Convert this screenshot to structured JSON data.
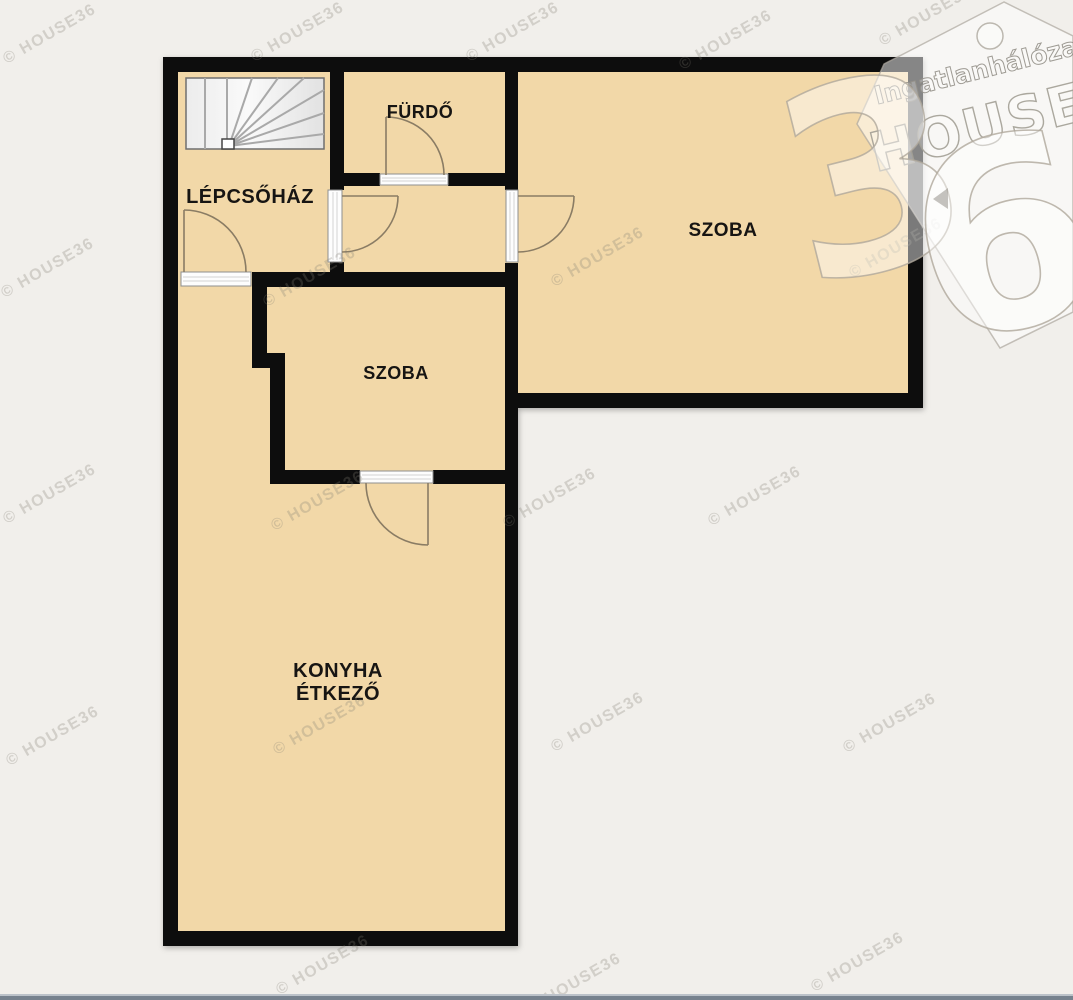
{
  "floorplan": {
    "rooms": {
      "lepcsohaz": {
        "label": "LÉPCSŐHÁZ"
      },
      "furdo": {
        "label": "FÜRDŐ"
      },
      "szoba_large": {
        "label": "SZOBA"
      },
      "szoba_small": {
        "label": "SZOBA"
      },
      "konyha": {
        "label_line1": "KONYHA",
        "label_line2": "ÉTKEZŐ"
      }
    },
    "colors": {
      "room_fill": "#f2d8a8",
      "wall": "#0d0d0d",
      "background": "#f1efeb",
      "door_arc": "#8a7c64",
      "bottom_bar": "#77828e"
    }
  },
  "branding": {
    "logo": {
      "network_text": "Ingatlanhálózat",
      "name_text": "HOUSE",
      "digit_left": "3",
      "digit_right": "6"
    },
    "watermark_text": "© HOUSE36",
    "watermarks": [
      {
        "x": 52,
        "y": 38
      },
      {
        "x": 300,
        "y": 36
      },
      {
        "x": 515,
        "y": 36
      },
      {
        "x": 728,
        "y": 44
      },
      {
        "x": 928,
        "y": 20
      },
      {
        "x": 50,
        "y": 272
      },
      {
        "x": 312,
        "y": 281
      },
      {
        "x": 600,
        "y": 261
      },
      {
        "x": 898,
        "y": 252
      },
      {
        "x": 52,
        "y": 498
      },
      {
        "x": 320,
        "y": 505
      },
      {
        "x": 552,
        "y": 502
      },
      {
        "x": 757,
        "y": 500
      },
      {
        "x": 55,
        "y": 740
      },
      {
        "x": 322,
        "y": 729
      },
      {
        "x": 600,
        "y": 726
      },
      {
        "x": 892,
        "y": 727
      },
      {
        "x": 325,
        "y": 969
      },
      {
        "x": 577,
        "y": 987
      },
      {
        "x": 860,
        "y": 966
      }
    ]
  }
}
